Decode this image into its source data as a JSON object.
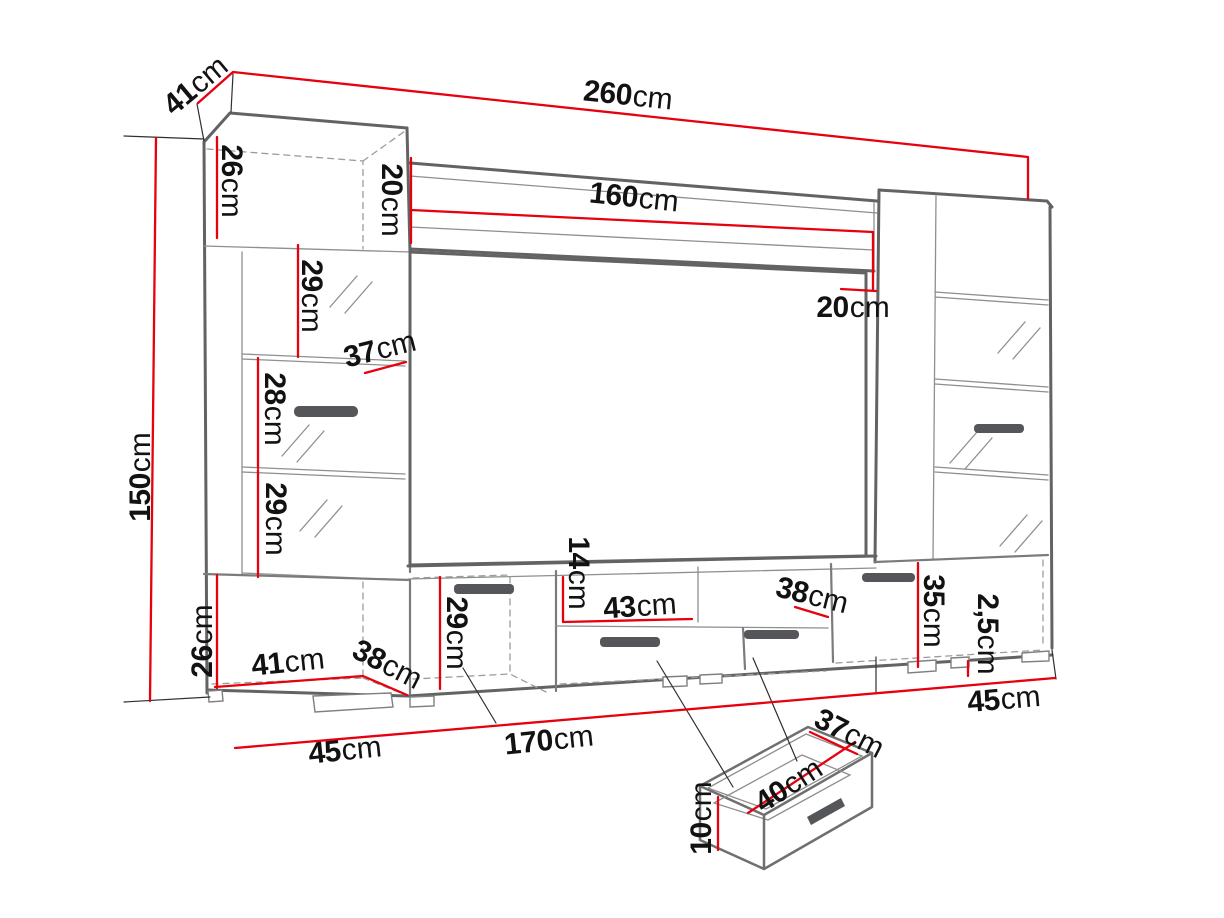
{
  "page": {
    "background": "#ffffff"
  },
  "diagram": {
    "kind": "furniture-dimension-drawing",
    "subject": "TV wall unit with two display columns, wall shelf, TV stand and pull-out drawer detail",
    "unit": "cm",
    "colors": {
      "dimension_line": "#e7000e",
      "outline_dark": "#636363",
      "outline_light": "#8f8f8f",
      "hidden_line": "#9c9c9c",
      "label_text": "#121212",
      "handle": "#55565a",
      "background": "#ffffff"
    },
    "labels": [
      {
        "name": "top-depth-41",
        "num": "41",
        "unit": "cm",
        "x": 196,
        "y": 86,
        "rot": -40
      },
      {
        "name": "total-width-260",
        "num": "260",
        "unit": "cm",
        "x": 628,
        "y": 96,
        "rot": 6
      },
      {
        "name": "top-cabinet-height-26",
        "num": "26",
        "unit": "cm",
        "x": 231,
        "y": 181,
        "rot": 90
      },
      {
        "name": "shelf-drop-left-20",
        "num": "20",
        "unit": "cm",
        "x": 391,
        "y": 200,
        "rot": 90
      },
      {
        "name": "shelf-width-160",
        "num": "160",
        "unit": "cm",
        "x": 634,
        "y": 198,
        "rot": 6
      },
      {
        "name": "shelf-end-height-20",
        "num": "20",
        "unit": "cm",
        "x": 853,
        "y": 308,
        "rot": 0
      },
      {
        "name": "left-upper-shelf-29",
        "num": "29",
        "unit": "cm",
        "x": 311,
        "y": 296,
        "rot": 90
      },
      {
        "name": "shelf-depth-37",
        "num": "37",
        "unit": "cm",
        "x": 380,
        "y": 350,
        "rot": -14
      },
      {
        "name": "left-middle-shelf-28",
        "num": "28",
        "unit": "cm",
        "x": 274,
        "y": 409,
        "rot": 90
      },
      {
        "name": "left-lower-shelf-29",
        "num": "29",
        "unit": "cm",
        "x": 275,
        "y": 519,
        "rot": 90
      },
      {
        "name": "total-height-150",
        "num": "150",
        "unit": "cm",
        "x": 141,
        "y": 477,
        "rot": -90
      },
      {
        "name": "base-left-height-26",
        "num": "26",
        "unit": "cm",
        "x": 203,
        "y": 641,
        "rot": -90
      },
      {
        "name": "base-left-width-41",
        "num": "41",
        "unit": "cm",
        "x": 288,
        "y": 663,
        "rot": -6
      },
      {
        "name": "base-left-depth-38",
        "num": "38",
        "unit": "cm",
        "x": 387,
        "y": 665,
        "rot": 27
      },
      {
        "name": "tv-stand-height-29",
        "num": "29",
        "unit": "cm",
        "x": 456,
        "y": 633,
        "rot": 90
      },
      {
        "name": "niche-height-14",
        "num": "14",
        "unit": "cm",
        "x": 578,
        "y": 573,
        "rot": 90
      },
      {
        "name": "niche-width-43",
        "num": "43",
        "unit": "cm",
        "x": 640,
        "y": 607,
        "rot": -4
      },
      {
        "name": "niche-right-width-38",
        "num": "38",
        "unit": "cm",
        "x": 812,
        "y": 596,
        "rot": 14
      },
      {
        "name": "base-right-height-35",
        "num": "35",
        "unit": "cm",
        "x": 933,
        "y": 611,
        "rot": 90
      },
      {
        "name": "plinth-height-2-5",
        "num": "2,5",
        "unit": "cm",
        "x": 987,
        "y": 634,
        "rot": 90
      },
      {
        "name": "floor-depth-right-45",
        "num": "45",
        "unit": "cm",
        "x": 1004,
        "y": 700,
        "rot": -5
      },
      {
        "name": "floor-depth-left-45",
        "num": "45",
        "unit": "cm",
        "x": 345,
        "y": 751,
        "rot": -6
      },
      {
        "name": "tv-stand-width-170",
        "num": "170",
        "unit": "cm",
        "x": 549,
        "y": 741,
        "rot": -6
      },
      {
        "name": "drawer-depth-37",
        "num": "37",
        "unit": "cm",
        "x": 849,
        "y": 734,
        "rot": 27
      },
      {
        "name": "drawer-width-40",
        "num": "40",
        "unit": "cm",
        "x": 789,
        "y": 786,
        "rot": -33
      },
      {
        "name": "drawer-height-10",
        "num": "10",
        "unit": "cm",
        "x": 702,
        "y": 818,
        "rot": -90
      }
    ]
  }
}
